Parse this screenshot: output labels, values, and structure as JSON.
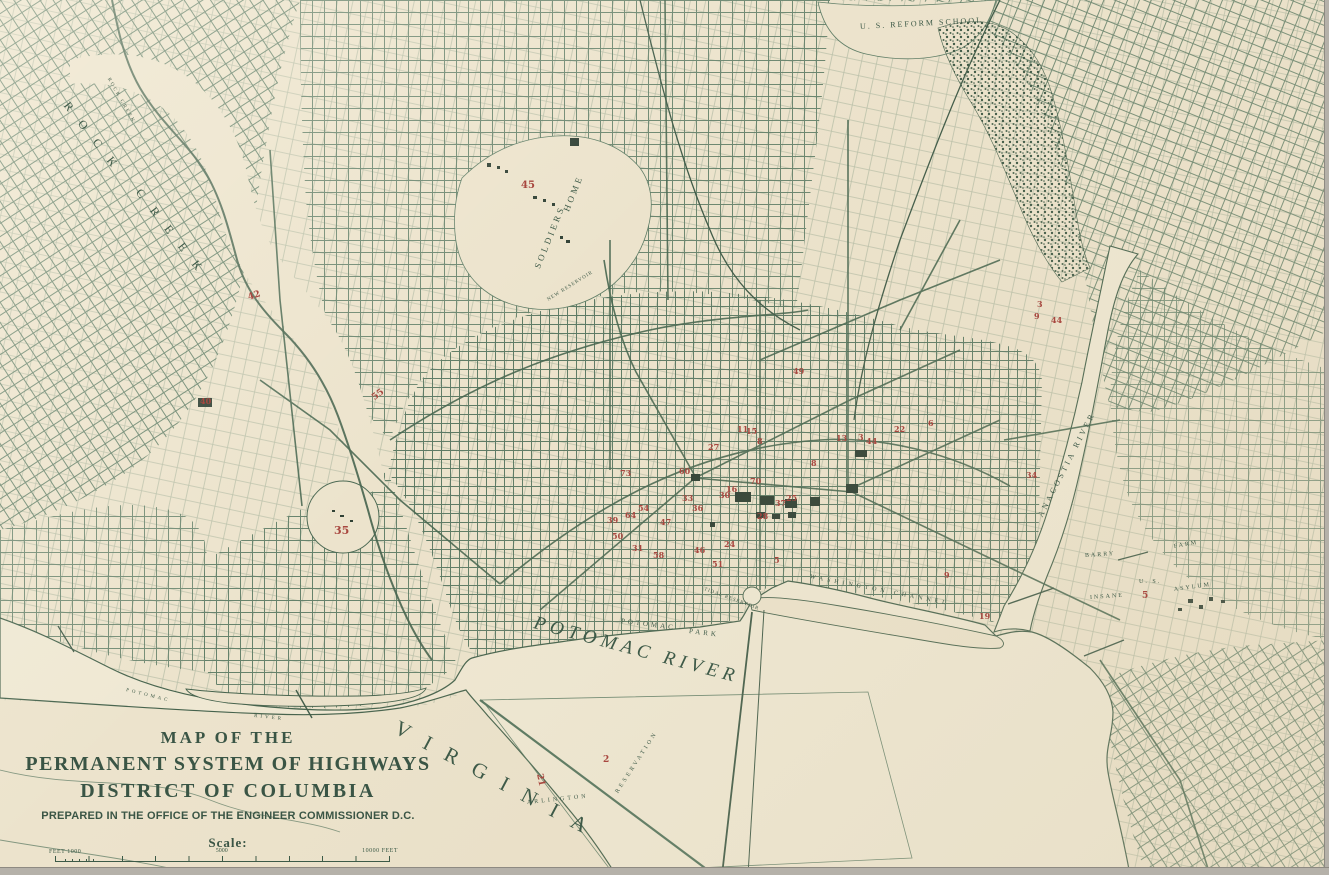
{
  "page": {
    "type": "scanned historical map"
  },
  "colors": {
    "paper": "#ece3cc",
    "ink_green": "#4a6852",
    "ink_dark": "#35503f",
    "plate_red": "#a8473f",
    "edge_gray": "#b5b1a9"
  },
  "title_block": {
    "line1": "MAP OF THE",
    "line2": "PERMANENT SYSTEM OF HIGHWAYS",
    "line3": "DISTRICT OF COLUMBIA",
    "line4": "PREPARED IN THE OFFICE OF THE ENGINEER COMMISSIONER D.C."
  },
  "scale_bar": {
    "label": "Scale:",
    "left": "FEET 1000",
    "middle": "5000",
    "right": "10000 FEET"
  },
  "map_labels": [
    {
      "text": "ROCK",
      "x": 66,
      "y": 96,
      "rot": 52,
      "size": 12,
      "ls": 15
    },
    {
      "text": "CREEK",
      "x": 138,
      "y": 183,
      "rot": 52,
      "size": 12,
      "ls": 15
    },
    {
      "text": "ROCK CREEK",
      "x": 108,
      "y": 76,
      "rot": 60,
      "size": 5,
      "ls": 2
    },
    {
      "text": "U. S. REFORM SCHOOL",
      "x": 860,
      "y": 22,
      "rot": -3,
      "size": 8,
      "ls": 2
    },
    {
      "text": "SOLDIERS",
      "x": 537,
      "y": 263,
      "rot": -68,
      "size": 9,
      "ls": 3
    },
    {
      "text": "HOME",
      "x": 566,
      "y": 206,
      "rot": -68,
      "size": 9,
      "ls": 3
    },
    {
      "text": "NEW RESERVOIR",
      "x": 548,
      "y": 298,
      "rot": -32,
      "size": 5,
      "ls": 1
    },
    {
      "text": "POTOMAC  RIVER",
      "x": 534,
      "y": 612,
      "rot": 15,
      "size": 19,
      "ls": 5,
      "italic": 1
    },
    {
      "text": "POTOMAC",
      "x": 621,
      "y": 617,
      "rot": 7,
      "size": 7,
      "ls": 3
    },
    {
      "text": "PARK",
      "x": 689,
      "y": 627,
      "rot": 7,
      "size": 7,
      "ls": 3
    },
    {
      "text": "TIDAL RESERVOIR",
      "x": 704,
      "y": 587,
      "rot": 20,
      "size": 5,
      "ls": 1
    },
    {
      "text": "WASHINGTON CHANNEL",
      "x": 810,
      "y": 574,
      "rot": 11,
      "size": 6,
      "ls": 4
    },
    {
      "text": "ANACOSTIA RIVER",
      "x": 1040,
      "y": 512,
      "rot": -63,
      "size": 8,
      "ls": 3
    },
    {
      "text": "VIRGINIA",
      "x": 396,
      "y": 714,
      "rot": 28,
      "size": 21,
      "ls": 17
    },
    {
      "text": "ARLINGTON",
      "x": 527,
      "y": 800,
      "rot": -6,
      "size": 6,
      "ls": 3
    },
    {
      "text": "RESERVATION",
      "x": 617,
      "y": 790,
      "rot": -57,
      "size": 6,
      "ls": 3
    },
    {
      "text": "BARRY",
      "x": 1085,
      "y": 553,
      "rot": -4,
      "size": 6,
      "ls": 2
    },
    {
      "text": "FARM",
      "x": 1174,
      "y": 544,
      "rot": -10,
      "size": 6,
      "ls": 2
    },
    {
      "text": "U. S.",
      "x": 1139,
      "y": 579,
      "rot": 0,
      "size": 6,
      "ls": 2
    },
    {
      "text": "INSANE",
      "x": 1090,
      "y": 595,
      "rot": -4,
      "size": 6,
      "ls": 2
    },
    {
      "text": "ASYLUM",
      "x": 1174,
      "y": 587,
      "rot": -8,
      "size": 6,
      "ls": 2
    },
    {
      "text": "POTOMAC",
      "x": 126,
      "y": 688,
      "rot": 14,
      "size": 5,
      "ls": 3
    },
    {
      "text": "RIVER",
      "x": 254,
      "y": 714,
      "rot": 6,
      "size": 5,
      "ls": 3
    }
  ],
  "red_plate_numbers": [
    {
      "n": "42",
      "x": 248,
      "y": 291,
      "rot": -18,
      "size": 9
    },
    {
      "n": "55",
      "x": 372,
      "y": 390,
      "rot": -38,
      "size": 9
    },
    {
      "n": "35",
      "x": 334,
      "y": 524,
      "size": 11
    },
    {
      "n": "40",
      "x": 200,
      "y": 396,
      "size": 8
    },
    {
      "n": "45",
      "x": 521,
      "y": 180,
      "size": 10
    },
    {
      "n": "49",
      "x": 793,
      "y": 366,
      "size": 8
    },
    {
      "n": "73",
      "x": 620,
      "y": 468,
      "size": 8
    },
    {
      "n": "39",
      "x": 607,
      "y": 515,
      "size": 8
    },
    {
      "n": "50",
      "x": 612,
      "y": 531,
      "size": 8
    },
    {
      "n": "64",
      "x": 625,
      "y": 510,
      "size": 8
    },
    {
      "n": "54",
      "x": 638,
      "y": 503,
      "size": 8
    },
    {
      "n": "58",
      "x": 653,
      "y": 550,
      "size": 8
    },
    {
      "n": "47",
      "x": 660,
      "y": 517,
      "size": 8
    },
    {
      "n": "33",
      "x": 682,
      "y": 493,
      "size": 8
    },
    {
      "n": "36",
      "x": 692,
      "y": 503,
      "size": 8
    },
    {
      "n": "60",
      "x": 679,
      "y": 466,
      "size": 8
    },
    {
      "n": "51",
      "x": 712,
      "y": 559,
      "size": 8
    },
    {
      "n": "30",
      "x": 719,
      "y": 490,
      "size": 8
    },
    {
      "n": "16",
      "x": 726,
      "y": 484,
      "size": 8
    },
    {
      "n": "15",
      "x": 746,
      "y": 426,
      "size": 8
    },
    {
      "n": "8",
      "x": 757,
      "y": 436,
      "size": 8
    },
    {
      "n": "70",
      "x": 750,
      "y": 476,
      "size": 8
    },
    {
      "n": "28",
      "x": 757,
      "y": 511,
      "size": 8
    },
    {
      "n": "37",
      "x": 775,
      "y": 498,
      "size": 8
    },
    {
      "n": "25",
      "x": 786,
      "y": 493,
      "size": 8
    },
    {
      "n": "5",
      "x": 774,
      "y": 555,
      "size": 8
    },
    {
      "n": "11",
      "x": 737,
      "y": 424,
      "size": 8
    },
    {
      "n": "27",
      "x": 708,
      "y": 442,
      "size": 8
    },
    {
      "n": "13",
      "x": 836,
      "y": 433,
      "size": 8
    },
    {
      "n": "8",
      "x": 811,
      "y": 458,
      "size": 8
    },
    {
      "n": "3",
      "x": 858,
      "y": 432,
      "size": 8
    },
    {
      "n": "44",
      "x": 866,
      "y": 436,
      "size": 8
    },
    {
      "n": "22",
      "x": 894,
      "y": 424,
      "size": 8
    },
    {
      "n": "6",
      "x": 928,
      "y": 418,
      "size": 8
    },
    {
      "n": "9",
      "x": 944,
      "y": 570,
      "size": 8
    },
    {
      "n": "19",
      "x": 979,
      "y": 611,
      "size": 8
    },
    {
      "n": "3",
      "x": 1037,
      "y": 299,
      "size": 8
    },
    {
      "n": "9",
      "x": 1034,
      "y": 311,
      "size": 8
    },
    {
      "n": "44",
      "x": 1051,
      "y": 315,
      "size": 8
    },
    {
      "n": "31",
      "x": 632,
      "y": 543,
      "size": 8
    },
    {
      "n": "46",
      "x": 694,
      "y": 545,
      "size": 8
    },
    {
      "n": "24",
      "x": 724,
      "y": 539,
      "size": 8
    },
    {
      "n": "34",
      "x": 1026,
      "y": 470,
      "size": 8
    },
    {
      "n": "2",
      "x": 603,
      "y": 755,
      "size": 9
    },
    {
      "n": "21",
      "x": 534,
      "y": 775,
      "rot": 78,
      "size": 9
    },
    {
      "n": "5",
      "x": 1142,
      "y": 591,
      "size": 9
    }
  ]
}
